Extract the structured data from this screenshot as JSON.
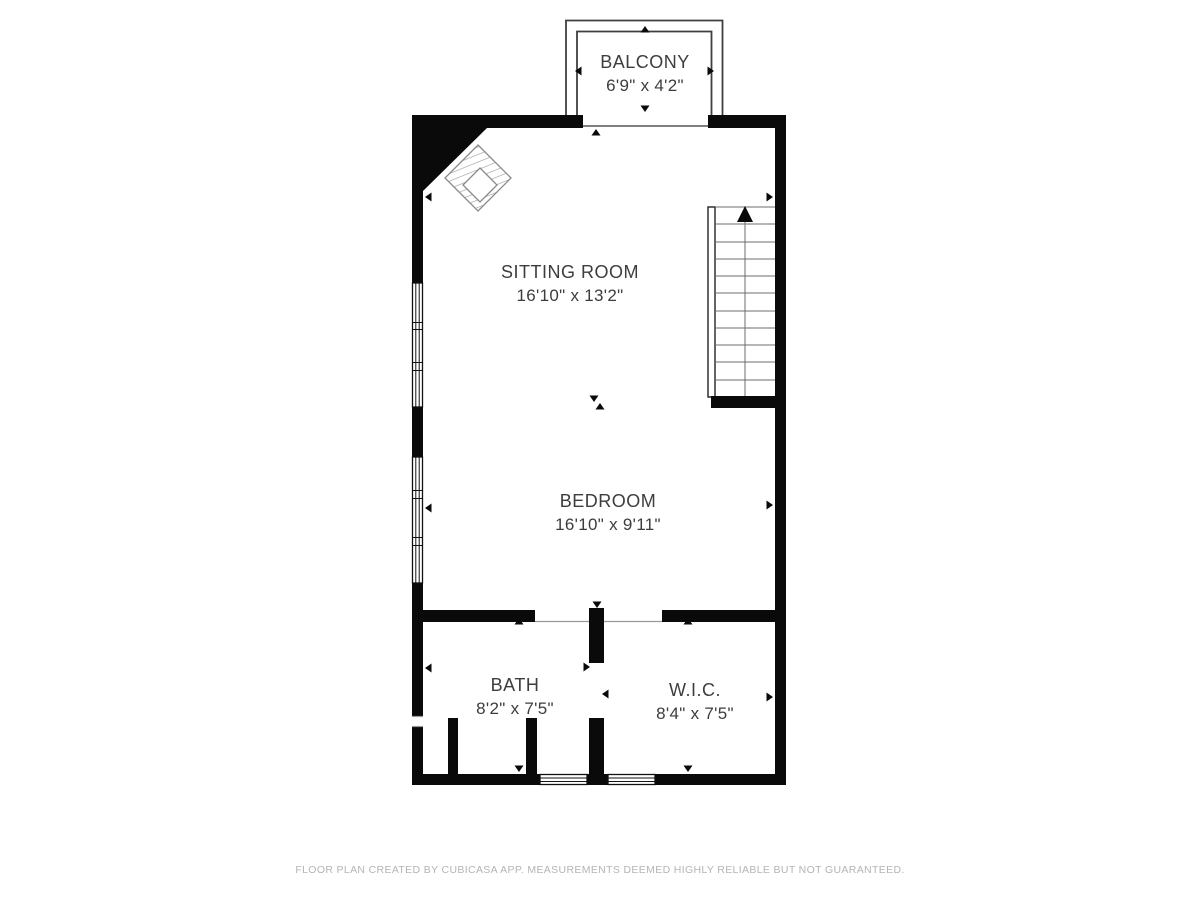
{
  "rooms": {
    "balcony": {
      "name": "BALCONY",
      "dimensions": "6'9\" x 4'2\""
    },
    "sitting_room": {
      "name": "SITTING ROOM",
      "dimensions": "16'10\" x 13'2\""
    },
    "bedroom": {
      "name": "BEDROOM",
      "dimensions": "16'10\" x 9'11\""
    },
    "bath": {
      "name": "BATH",
      "dimensions": "8'2\" x 7'5\""
    },
    "wic": {
      "name": "W.I.C.",
      "dimensions": "8'4\" x 7'5\""
    }
  },
  "footer": {
    "disclaimer": "FLOOR PLAN CREATED BY CUBICASA APP. MEASUREMENTS DEEMED HIGHLY RELIABLE BUT NOT GUARANTEED."
  },
  "features": {
    "staircase": "stairs-with-up-arrow",
    "fireplace": "corner-fireplace-diamond",
    "balcony_railing": "double-line-railing",
    "windows": "triple-pane-wall-windows",
    "dimension_arrows": "room-extent-arrows"
  },
  "colors": {
    "wall": "#0a0a0a",
    "room_text": "#3d3d3d",
    "footer_text": "#b4b4b4",
    "background": "#ffffff"
  }
}
